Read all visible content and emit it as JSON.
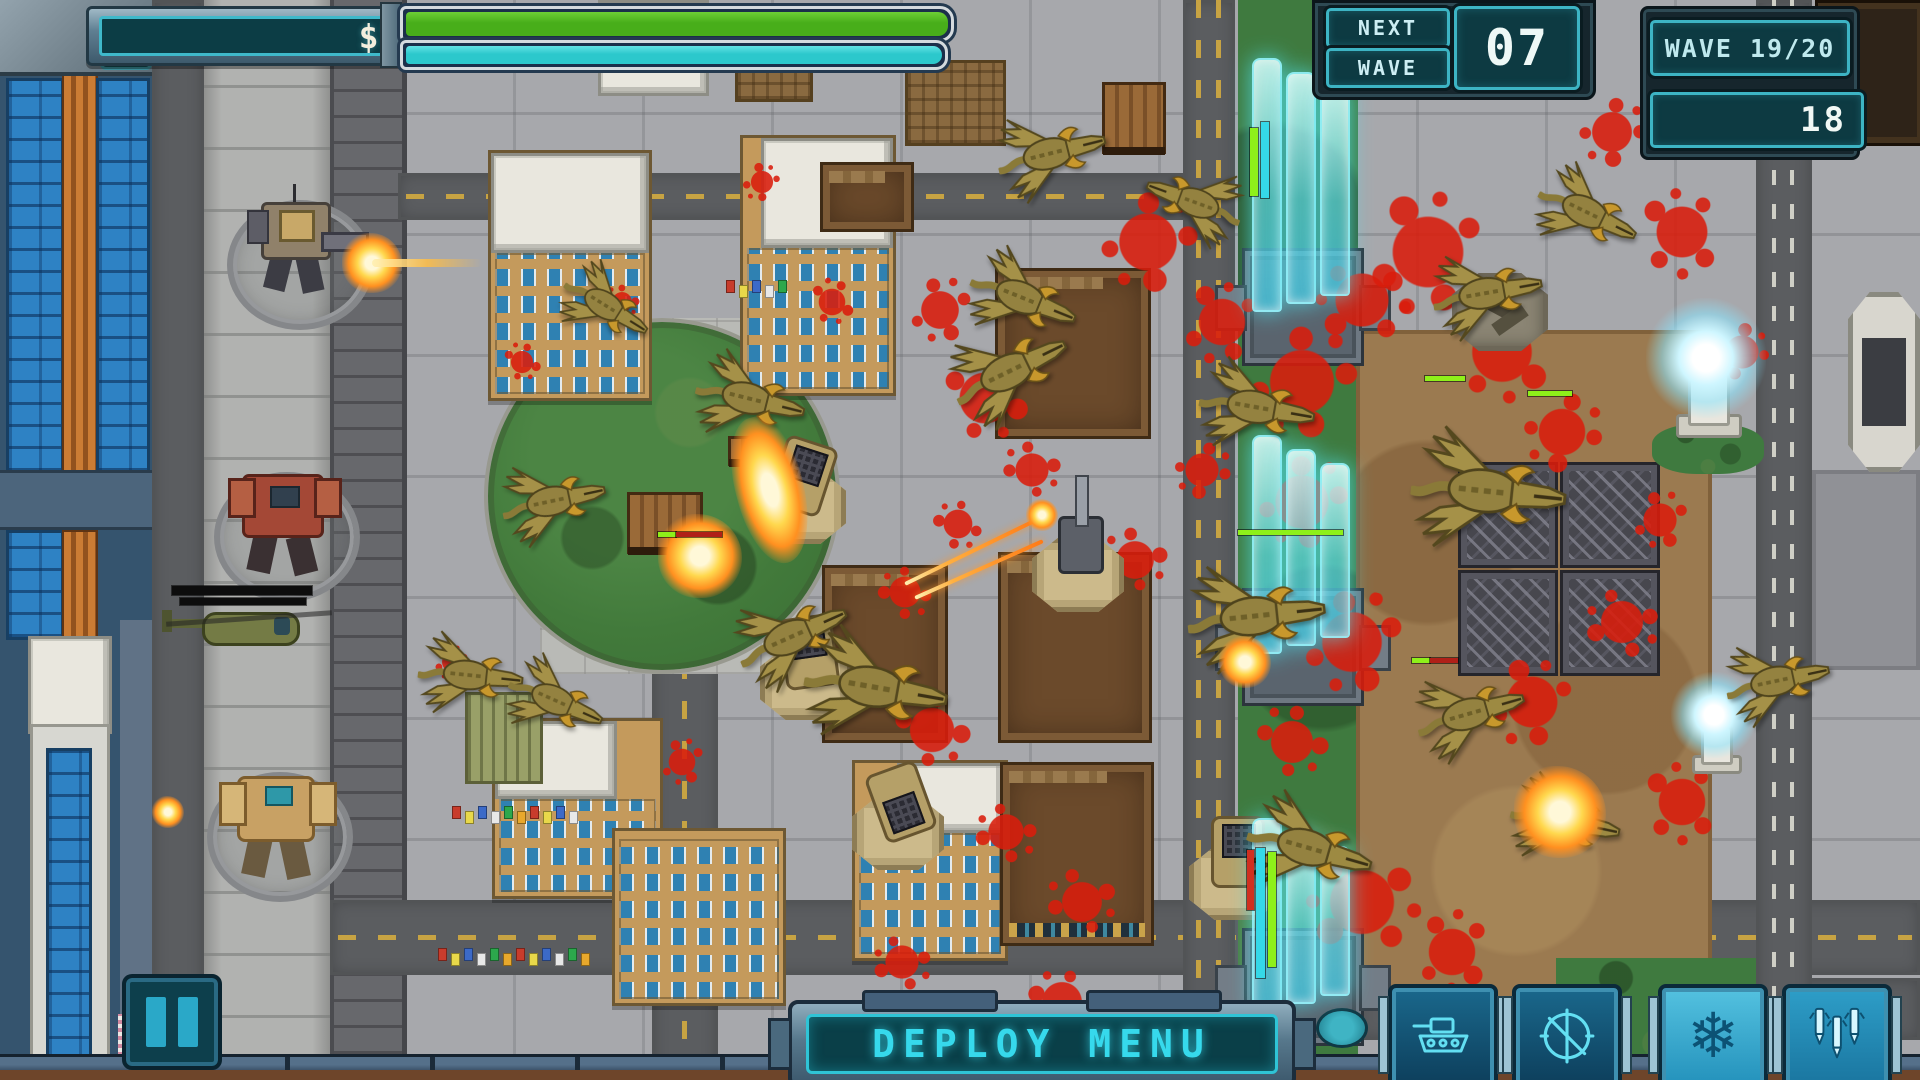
{
  "hud": {
    "money": "$5315",
    "bars": {
      "health": {
        "pct": 100,
        "color_top": "#6dcf35",
        "color": "#48ae1a"
      },
      "shield": {
        "pct": 100,
        "color_top": "#63e2e4",
        "color": "#2cc8cc"
      }
    },
    "next_wave": {
      "top": "NEXT",
      "bottom": "WAVE",
      "countdown": "07"
    },
    "wave_label": "WAVE 19/20",
    "enemies_left": "18",
    "deploy_label": "DEPLOY MENU",
    "pause_icon": "pause",
    "abilities": [
      {
        "id": "deploy-tank",
        "icon": "tank",
        "style": "dark"
      },
      {
        "id": "deploy-turret",
        "icon": "crosshair",
        "style": "dark"
      },
      {
        "id": "freeze",
        "icon": "snowflake",
        "style": "light"
      },
      {
        "id": "missile-strike",
        "icon": "missiles",
        "style": "mid"
      }
    ]
  },
  "colors": {
    "hud_screen": "#0d3a42",
    "hud_border": "#3db4c4",
    "accent_cyan": "#36d9ec",
    "money_text": "#f3eedd",
    "health_green": "#48ae1a",
    "shield_cyan": "#2cc8cc",
    "blood_red": "#da1d0c",
    "barrier_cyan": "#5ee2f0",
    "kaiju_olive": "#97843e"
  },
  "field": {
    "people_palette": [
      "#c83c2c",
      "#e8d84a",
      "#3c6ac8",
      "#e8e8e8",
      "#2ca84c",
      "#e8a82c"
    ],
    "buildings": [
      {
        "x": 488,
        "y": 150,
        "w": 158,
        "h": 245,
        "kind": "tan",
        "pent": [
          0,
          0,
          158,
          100
        ]
      },
      {
        "x": 740,
        "y": 135,
        "w": 150,
        "h": 255,
        "kind": "tan",
        "pent": [
          18,
          0,
          132,
          110
        ]
      },
      {
        "x": 492,
        "y": 718,
        "w": 165,
        "h": 175,
        "kind": "tan",
        "pent": [
          0,
          0,
          122,
          78
        ]
      },
      {
        "x": 612,
        "y": 828,
        "w": 168,
        "h": 172,
        "kind": "tan"
      },
      {
        "x": 852,
        "y": 760,
        "w": 150,
        "h": 195,
        "kind": "tan",
        "pent": [
          42,
          0,
          108,
          70
        ]
      },
      {
        "x": 598,
        "y": 0,
        "w": 105,
        "h": 90,
        "kind": "white"
      },
      {
        "x": 905,
        "y": 60,
        "w": 95,
        "h": 80,
        "kind": "brown"
      },
      {
        "x": 735,
        "y": 38,
        "w": 72,
        "h": 58,
        "kind": "brown"
      },
      {
        "x": 465,
        "y": 692,
        "w": 72,
        "h": 86,
        "kind": "shed"
      }
    ],
    "ruins": [
      {
        "x": 995,
        "y": 268,
        "w": 150,
        "h": 165
      },
      {
        "x": 998,
        "y": 552,
        "w": 148,
        "h": 185
      },
      {
        "x": 1000,
        "y": 762,
        "w": 148,
        "h": 178,
        "deco": true
      },
      {
        "x": 822,
        "y": 565,
        "w": 120,
        "h": 172
      },
      {
        "x": 820,
        "y": 162,
        "w": 88,
        "h": 64
      },
      {
        "x": 1815,
        "y": 0,
        "w": 105,
        "h": 140,
        "dark": true
      }
    ],
    "gates": [
      {
        "blad_y": 58,
        "blad_h": 250,
        "mount_y": 248
      },
      {
        "blad_y": 435,
        "blad_h": 215,
        "mount_y": 588
      },
      {
        "blad_y": 818,
        "blad_h": 190,
        "mount_y": 928
      }
    ],
    "spike_tiles": {
      "x": 1458,
      "y": 462,
      "cols": 2,
      "rows": 2,
      "tw": 94,
      "th": 100,
      "gap": 8
    },
    "turrets": [
      {
        "x": 800,
        "y": 492,
        "rot": 18,
        "type": "missile"
      },
      {
        "x": 806,
        "y": 668,
        "rot": -8,
        "type": "missile"
      },
      {
        "x": 898,
        "y": 818,
        "rot": 160,
        "type": "missile"
      },
      {
        "x": 1078,
        "y": 560,
        "rot": -118,
        "type": "gun"
      },
      {
        "x": 1235,
        "y": 868,
        "rot": 0,
        "type": "missile"
      },
      {
        "x": 1500,
        "y": 305,
        "rot": 20,
        "type": "destroyed"
      }
    ],
    "teslas": [
      {
        "x": 1706,
        "y": 368,
        "s": 1
      },
      {
        "x": 1714,
        "y": 722,
        "s": 0.72
      }
    ],
    "mechs": [
      {
        "type": "gunner",
        "x": 295,
        "y": 240
      },
      {
        "type": "red",
        "x": 282,
        "y": 512
      },
      {
        "type": "heli",
        "x": 248,
        "y": 626
      },
      {
        "type": "tan",
        "x": 275,
        "y": 812
      }
    ],
    "kaiju": [
      {
        "x": 755,
        "y": 400,
        "rot": 14,
        "s": 1
      },
      {
        "x": 558,
        "y": 500,
        "rot": -12,
        "s": 0.95
      },
      {
        "x": 610,
        "y": 308,
        "rot": 32,
        "s": 0.85
      },
      {
        "x": 475,
        "y": 676,
        "rot": 6,
        "s": 0.95
      },
      {
        "x": 560,
        "y": 702,
        "rot": 24,
        "s": 0.9
      },
      {
        "x": 797,
        "y": 634,
        "rot": -24,
        "s": 1.05
      },
      {
        "x": 882,
        "y": 688,
        "rot": 10,
        "s": 1.3
      },
      {
        "x": 1056,
        "y": 152,
        "rot": -14,
        "s": 1
      },
      {
        "x": 1190,
        "y": 200,
        "rot": -160,
        "s": 0.9,
        "flip": true
      },
      {
        "x": 1028,
        "y": 300,
        "rot": 22,
        "s": 1
      },
      {
        "x": 1015,
        "y": 368,
        "rot": -26,
        "s": 1.1
      },
      {
        "x": 1262,
        "y": 408,
        "rot": 10,
        "s": 1.05
      },
      {
        "x": 1262,
        "y": 615,
        "rot": -6,
        "s": 1.25
      },
      {
        "x": 1315,
        "y": 850,
        "rot": 16,
        "s": 1.15
      },
      {
        "x": 1492,
        "y": 292,
        "rot": -10,
        "s": 1
      },
      {
        "x": 1495,
        "y": 492,
        "rot": 6,
        "s": 1.4
      },
      {
        "x": 1475,
        "y": 712,
        "rot": -16,
        "s": 1
      },
      {
        "x": 1592,
        "y": 215,
        "rot": 26,
        "s": 0.95
      },
      {
        "x": 1782,
        "y": 680,
        "rot": -12,
        "s": 0.95
      },
      {
        "x": 1570,
        "y": 822,
        "rot": 12,
        "s": 1
      }
    ],
    "explosions": [
      {
        "x": 700,
        "y": 556,
        "r": 42
      },
      {
        "x": 1560,
        "y": 812,
        "r": 46
      },
      {
        "x": 1245,
        "y": 662,
        "r": 26
      },
      {
        "x": 770,
        "y": 490,
        "r": 34,
        "stretch": 2.2,
        "rot": 75
      },
      {
        "x": 372,
        "y": 263,
        "r": 30,
        "beam": 110
      },
      {
        "x": 168,
        "y": 812,
        "r": 16
      }
    ],
    "blood": [
      {
        "x": 940,
        "y": 310,
        "r": 34
      },
      {
        "x": 985,
        "y": 398,
        "r": 46
      },
      {
        "x": 1032,
        "y": 470,
        "r": 30
      },
      {
        "x": 958,
        "y": 524,
        "r": 26
      },
      {
        "x": 905,
        "y": 592,
        "r": 28
      },
      {
        "x": 932,
        "y": 730,
        "r": 40
      },
      {
        "x": 1006,
        "y": 832,
        "r": 32
      },
      {
        "x": 1082,
        "y": 902,
        "r": 36
      },
      {
        "x": 1148,
        "y": 242,
        "r": 52
      },
      {
        "x": 1222,
        "y": 322,
        "r": 42
      },
      {
        "x": 1302,
        "y": 382,
        "r": 58
      },
      {
        "x": 1362,
        "y": 300,
        "r": 48
      },
      {
        "x": 1428,
        "y": 252,
        "r": 64
      },
      {
        "x": 1502,
        "y": 352,
        "r": 54
      },
      {
        "x": 1562,
        "y": 432,
        "r": 42
      },
      {
        "x": 1302,
        "y": 502,
        "r": 48
      },
      {
        "x": 1352,
        "y": 642,
        "r": 54
      },
      {
        "x": 1292,
        "y": 742,
        "r": 38
      },
      {
        "x": 1362,
        "y": 902,
        "r": 58
      },
      {
        "x": 1452,
        "y": 952,
        "r": 42
      },
      {
        "x": 1612,
        "y": 132,
        "r": 36
      },
      {
        "x": 1682,
        "y": 232,
        "r": 46
      },
      {
        "x": 1742,
        "y": 352,
        "r": 30
      },
      {
        "x": 1622,
        "y": 622,
        "r": 38
      },
      {
        "x": 1682,
        "y": 802,
        "r": 42
      },
      {
        "x": 1532,
        "y": 702,
        "r": 46
      },
      {
        "x": 832,
        "y": 302,
        "r": 24
      },
      {
        "x": 762,
        "y": 182,
        "r": 20
      },
      {
        "x": 622,
        "y": 302,
        "r": 18
      },
      {
        "x": 522,
        "y": 362,
        "r": 20
      },
      {
        "x": 452,
        "y": 662,
        "r": 18
      },
      {
        "x": 682,
        "y": 762,
        "r": 24
      },
      {
        "x": 902,
        "y": 962,
        "r": 30
      },
      {
        "x": 1062,
        "y": 1002,
        "r": 36
      },
      {
        "x": 1202,
        "y": 470,
        "r": 30
      },
      {
        "x": 1240,
        "y": 870,
        "r": 40
      },
      {
        "x": 1135,
        "y": 560,
        "r": 34
      },
      {
        "x": 1660,
        "y": 520,
        "r": 30
      }
    ],
    "bars": [
      {
        "x": 1250,
        "y": 128,
        "w": 8,
        "h": 68,
        "c": "#8ef01a"
      },
      {
        "x": 1261,
        "y": 122,
        "w": 8,
        "h": 76,
        "c": "#35d8e8"
      },
      {
        "x": 1238,
        "y": 530,
        "w": 105,
        "h": 5,
        "c": "#8ef01a"
      },
      {
        "x": 1256,
        "y": 848,
        "w": 9,
        "h": 130,
        "c": "#35d8e8"
      },
      {
        "x": 1268,
        "y": 852,
        "w": 8,
        "h": 115,
        "c": "#8ef01a"
      },
      {
        "x": 1247,
        "y": 850,
        "w": 7,
        "h": 60,
        "c": "#d03020"
      },
      {
        "x": 1425,
        "y": 376,
        "w": 40,
        "h": 5,
        "c": "#8ef01a"
      },
      {
        "x": 1528,
        "y": 391,
        "w": 44,
        "h": 5,
        "c": "#8ef01a"
      },
      {
        "x": 658,
        "y": 532,
        "w": 18,
        "h": 5,
        "c": "#8ef01a"
      },
      {
        "x": 676,
        "y": 532,
        "w": 46,
        "h": 5,
        "c": "#b02018"
      },
      {
        "x": 1412,
        "y": 658,
        "w": 18,
        "h": 5,
        "c": "#8ef01a"
      },
      {
        "x": 1430,
        "y": 658,
        "w": 28,
        "h": 5,
        "c": "#b02018"
      },
      {
        "x": 172,
        "y": 586,
        "w": 140,
        "h": 9,
        "c": "#0d0d0d"
      },
      {
        "x": 180,
        "y": 598,
        "w": 126,
        "h": 7,
        "c": "#0d0d0d"
      }
    ],
    "crates": [
      {
        "x": 627,
        "y": 492,
        "w": 70,
        "h": 56
      },
      {
        "x": 1102,
        "y": 82,
        "w": 58,
        "h": 66
      },
      {
        "x": 728,
        "y": 436,
        "w": 28,
        "h": 24
      }
    ],
    "people_rows": [
      {
        "x": 452,
        "y": 806,
        "n": 10
      },
      {
        "x": 438,
        "y": 948,
        "n": 12
      },
      {
        "x": 726,
        "y": 280,
        "n": 5
      }
    ],
    "deploy_pad_oval": {
      "x": 1316,
      "y": 1008,
      "w": 46,
      "h": 34
    }
  }
}
